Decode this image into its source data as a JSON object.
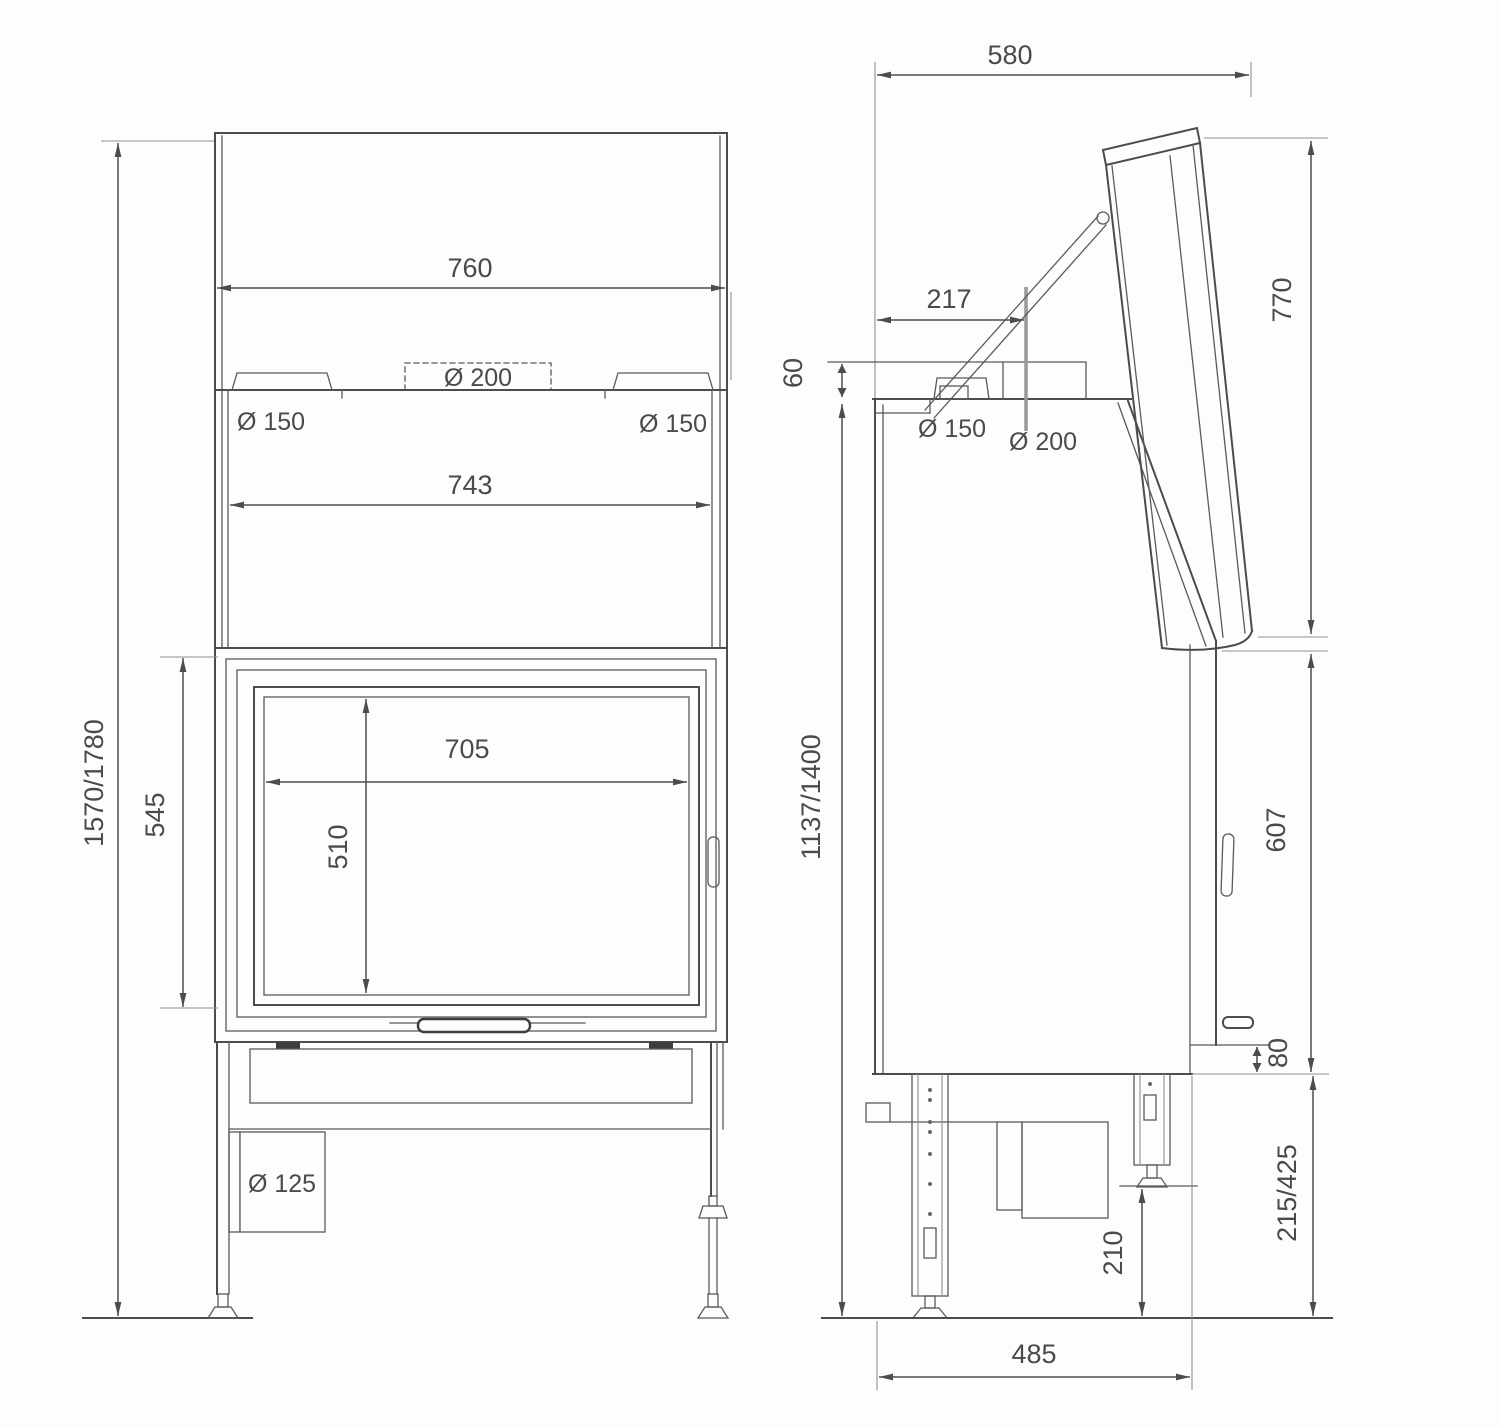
{
  "front_view": {
    "overall_width": "760",
    "flue_left": "Ø 150",
    "flue_center": "Ø 200",
    "flue_right": "Ø 150",
    "inner_width": "743",
    "glass_width": "705",
    "glass_height": "510",
    "door_height": "545",
    "overall_height": "1570/1780",
    "air_inlet": "Ø 125"
  },
  "side_view": {
    "depth": "580",
    "flue_offset": "217",
    "collar_height": "60",
    "flue_150": "Ø 150",
    "flue_200": "Ø 200",
    "open_door_height": "770",
    "body_height": "1137/1400",
    "front_height": "607",
    "bottom_step": "80",
    "leg_range": "215/425",
    "foot_height": "210",
    "base_depth": "485"
  }
}
